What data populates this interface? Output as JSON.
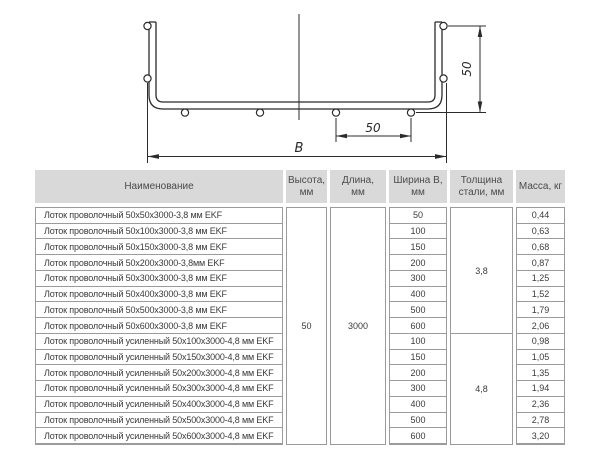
{
  "diagram": {
    "width_dim_label": "B",
    "wire_spacing_dim_label": "50",
    "height_dim_label": "50"
  },
  "table": {
    "headers": {
      "name": "Наименование",
      "height": "Высота,\nмм",
      "length": "Длина,\nмм",
      "width": "Ширина В,\nмм",
      "thickness": "Толщина\nстали, мм",
      "mass": "Масса, кг"
    },
    "merged": {
      "height_mm": "50",
      "length_mm": "3000",
      "thickness_group1_mm": "3,8",
      "thickness_group2_mm": "4,8"
    },
    "rows": [
      {
        "name": "Лоток проволочный 50х50х3000-3,8 мм EKF",
        "width_mm": "50",
        "mass_kg": "0,44"
      },
      {
        "name": "Лоток проволочный 50х100х3000-3,8 мм EKF",
        "width_mm": "100",
        "mass_kg": "0,63"
      },
      {
        "name": "Лоток проволочный 50х150х3000-3,8 мм EKF",
        "width_mm": "150",
        "mass_kg": "0,68"
      },
      {
        "name": "Лоток проволочный 50х200х3000-3,8мм EKF",
        "width_mm": "200",
        "mass_kg": "0,87"
      },
      {
        "name": "Лоток проволочный 50х300х3000-3,8 мм EKF",
        "width_mm": "300",
        "mass_kg": "1,25"
      },
      {
        "name": "Лоток проволочный 50х400х3000-3,8 мм EKF",
        "width_mm": "400",
        "mass_kg": "1,52"
      },
      {
        "name": "Лоток проволочный 50х500х3000-3,8 мм EKF",
        "width_mm": "500",
        "mass_kg": "1,79"
      },
      {
        "name": "Лоток проволочный 50х600х3000-3,8 мм EKF",
        "width_mm": "600",
        "mass_kg": "2,06"
      },
      {
        "name": "Лоток проволочный усиленный 50х100х3000-4,8 мм EKF",
        "width_mm": "100",
        "mass_kg": "0,98"
      },
      {
        "name": "Лоток проволочный усиленный 50х150х3000-4,8 мм EKF",
        "width_mm": "150",
        "mass_kg": "1,05"
      },
      {
        "name": "Лоток проволочный усиленный 50х200х3000-4,8 мм EKF",
        "width_mm": "200",
        "mass_kg": "1,35"
      },
      {
        "name": "Лоток проволочный усиленный 50х300х3000-4,8 мм EKF",
        "width_mm": "300",
        "mass_kg": "1,94"
      },
      {
        "name": "Лоток проволочный усиленный 50х400х3000-4,8 мм EKF",
        "width_mm": "400",
        "mass_kg": "2,36"
      },
      {
        "name": "Лоток проволочный усиленный 50х500х3000-4,8 мм EKF",
        "width_mm": "500",
        "mass_kg": "2,78"
      },
      {
        "name": "Лоток проволочный усиленный 50х600х3000-4,8 мм EKF",
        "width_mm": "600",
        "mass_kg": "3,20"
      }
    ]
  }
}
